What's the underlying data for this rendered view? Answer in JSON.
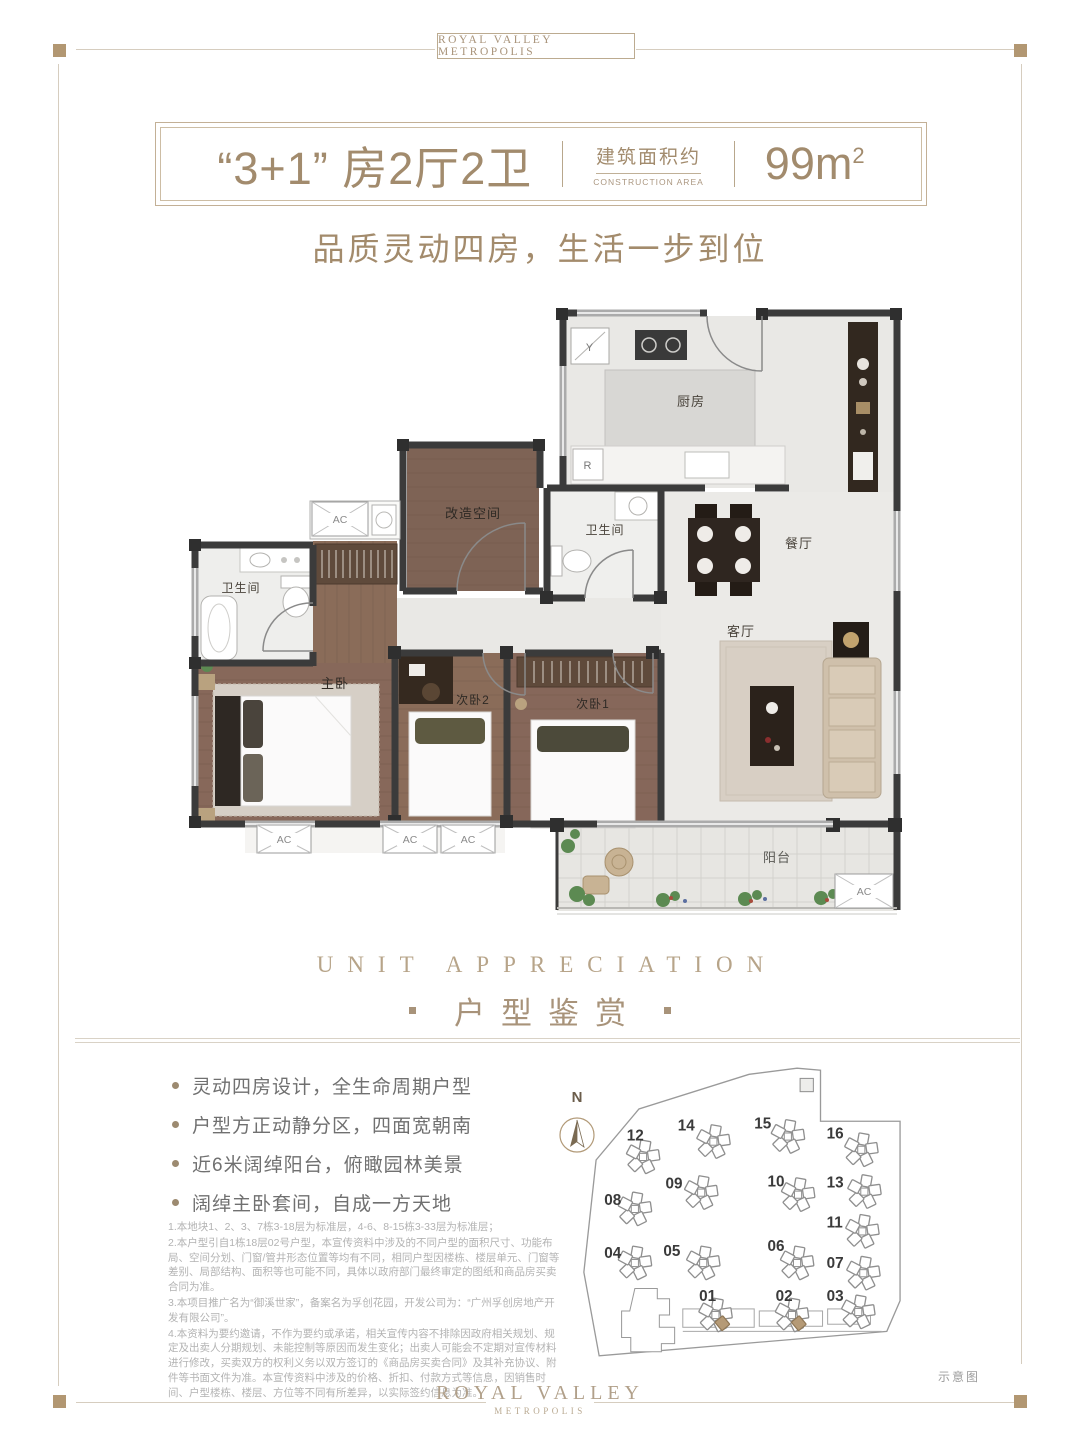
{
  "brand": {
    "header": "ROYAL VALLEY METROPOLIS",
    "footer_line1": "ROYAL VALLEY",
    "footer_line2": "METROPOLIS"
  },
  "title": {
    "main": "“3+1” 房2厅2卫",
    "area_label_cn": "建筑面积约",
    "area_label_en": "CONSTRUCTION AREA",
    "area_value": "99m",
    "area_sup": "2"
  },
  "subtitle": "品质灵动四房，生活一步到位",
  "section": {
    "en": "UNIT APPRECIATION",
    "cn": "户型鉴赏"
  },
  "floorplan": {
    "rooms": {
      "kitchen": "厨房",
      "dining": "餐厅",
      "living": "客厅",
      "balcony": "阳台",
      "master": "主卧",
      "bed1": "次卧1",
      "bed2": "次卧2",
      "bath1": "卫生间",
      "bath2": "卫生间",
      "flex": "改造空间"
    },
    "marks": {
      "y": "Y",
      "r": "R",
      "ac": "AC"
    }
  },
  "features": [
    "灵动四房设计，全生命周期户型",
    "户型方正动静分区，四面宽朝南",
    "近6米阔绰阳台，俯瞰园林美景",
    "阔绰主卧套间，自成一方天地"
  ],
  "disclaimer": [
    "1.本地块1、2、3、7栋3-18层为标准层，4-6、8-15栋3-33层为标准层；",
    "2.本户型引自1栋18层02号户型，本宣传资料中涉及的不同户型的面积尺寸、功能布局、空间分划、门窗/管井形态位置等均有不同，相同户型因楼栋、楼层单元、门窗等差别、局部结构、面积等也可能不同，具体以政府部门最终审定的图纸和商品房买卖合同为准。",
    "3.本项目推广名为“御溪世家”，备案名为孚创花园，开发公司为：“广州孚创房地产开发有限公司”。",
    "4.本资料为要约邀请，不作为要约或承诺，相关宣传内容不排除因政府相关规划、规定及出卖人分期规划、未能控制等原因而发生变化；出卖人可能会不定期对宣传材料进行修改，买卖双方的权利义务以双方签订的《商品房买卖合同》及其补充协议、附件等书面文件为准。本宣传资料中涉及的价格、折扣、付款方式等信息，因销售时间、户型楼栋、楼层、方位等不同有所差异，以实际签约信息为准。"
  ],
  "siteplan": {
    "north": "N",
    "buildings": [
      "01",
      "02",
      "03",
      "04",
      "05",
      "06",
      "07",
      "08",
      "09",
      "10",
      "11",
      "12",
      "13",
      "14",
      "15",
      "16"
    ]
  },
  "note": "示意图",
  "colors": {
    "accent": "#a8937a",
    "square": "#b29772",
    "wall": "#3b3b3b",
    "wood": "#87685a"
  }
}
